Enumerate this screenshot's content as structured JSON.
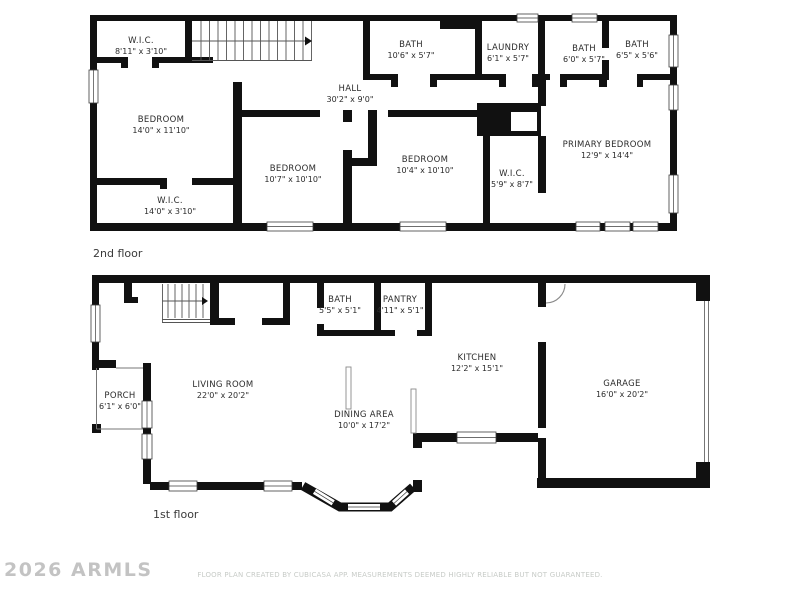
{
  "colors": {
    "background": "#ffffff",
    "wall": "#111111",
    "room_label_text": "#2b2b2b",
    "floor_label_text": "#3a3a3a",
    "watermark_text": "#b0b0b0",
    "footer_text": "#c7cbc7"
  },
  "floors": [
    {
      "label": "2nd floor",
      "rooms": [
        {
          "name": "W.I.C.",
          "dims": "8'11\" x 3'10\""
        },
        {
          "name": "BATH",
          "dims": "10'6\" x 5'7\""
        },
        {
          "name": "LAUNDRY",
          "dims": "6'1\" x 5'7\""
        },
        {
          "name": "BATH",
          "dims": "6'0\" x 5'7\""
        },
        {
          "name": "BATH",
          "dims": "6'5\" x 5'6\""
        },
        {
          "name": "HALL",
          "dims": "30'2\" x 9'0\""
        },
        {
          "name": "BEDROOM",
          "dims": "14'0\" x 11'10\""
        },
        {
          "name": "BEDROOM",
          "dims": "10'7\" x 10'10\""
        },
        {
          "name": "BEDROOM",
          "dims": "10'4\" x 10'10\""
        },
        {
          "name": "W.I.C.",
          "dims": "5'9\" x 8'7\""
        },
        {
          "name": "PRIMARY BEDROOM",
          "dims": "12'9\" x 14'4\""
        },
        {
          "name": "W.I.C.",
          "dims": "14'0\" x 3'10\""
        }
      ]
    },
    {
      "label": "1st floor",
      "rooms": [
        {
          "name": "BATH",
          "dims": "5'5\" x 5'1\""
        },
        {
          "name": "PANTRY",
          "dims": "4'11\" x 5'1\""
        },
        {
          "name": "KITCHEN",
          "dims": "12'2\" x 15'1\""
        },
        {
          "name": "GARAGE",
          "dims": "16'0\" x 20'2\""
        },
        {
          "name": "PORCH",
          "dims": "6'1\" x 6'0\""
        },
        {
          "name": "LIVING ROOM",
          "dims": "22'0\" x 20'2\""
        },
        {
          "name": "DINING AREA",
          "dims": "10'0\" x 17'2\""
        }
      ]
    }
  ],
  "watermark": "2026 ARMLS",
  "footer": "FLOOR PLAN CREATED BY CUBICASA APP. MEASUREMENTS DEEMED HIGHLY RELIABLE BUT NOT GUARANTEED."
}
